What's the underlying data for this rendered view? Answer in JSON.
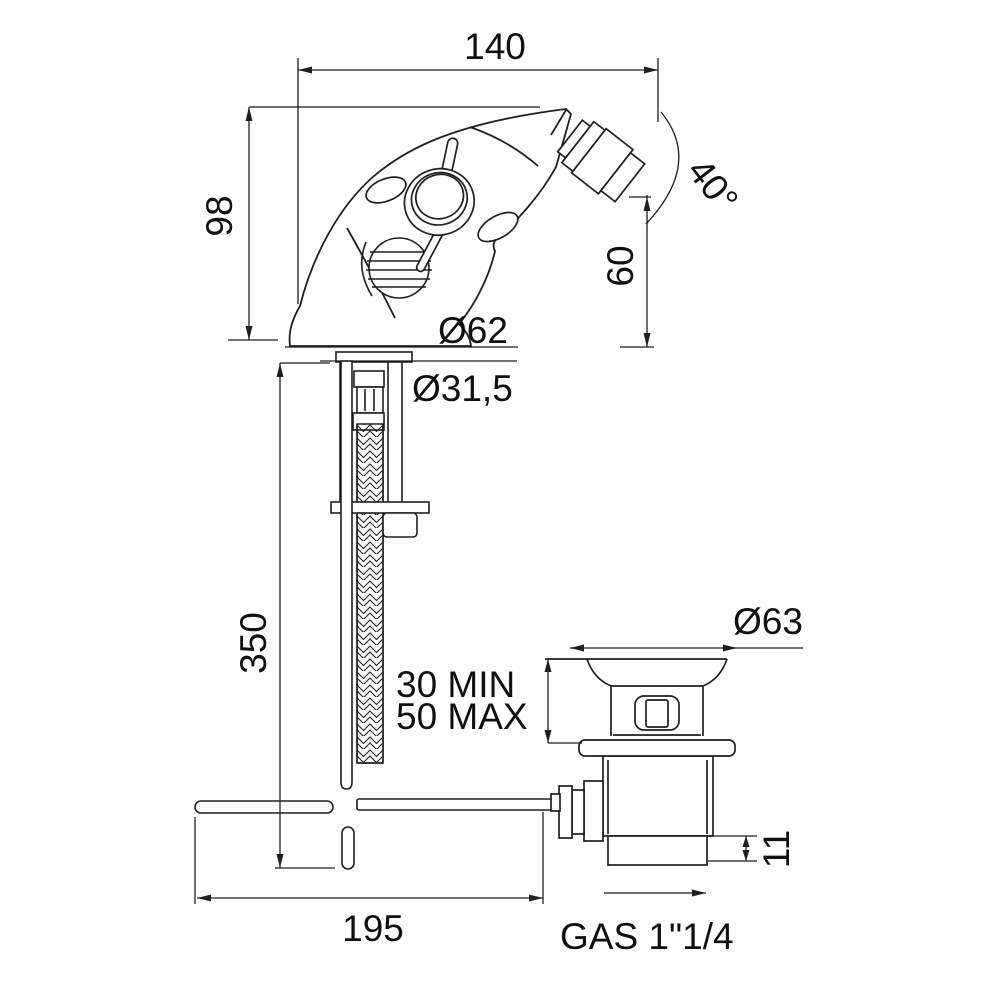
{
  "page": {
    "background": "#ffffff"
  },
  "drawing": {
    "name": "bidet-single-hole-mixer-with-popup-waste-technical-drawing",
    "colors": {
      "line": "#1f1f1f",
      "text": "#101010",
      "background": "#ffffff"
    },
    "dims": {
      "spout_reach": "140",
      "body_height": "98",
      "spout_angle": "40°",
      "outlet_height": "60",
      "base_diameter": "Ø62",
      "shank_diameter": "Ø31,5",
      "hose_length": "350",
      "deck_min": "30 MIN",
      "deck_max": "50 MAX",
      "waste_flange_diameter": "Ø63",
      "waste_collar_height": "11",
      "rod_length": "195",
      "waste_thread": "GAS 1\"1/4"
    }
  }
}
